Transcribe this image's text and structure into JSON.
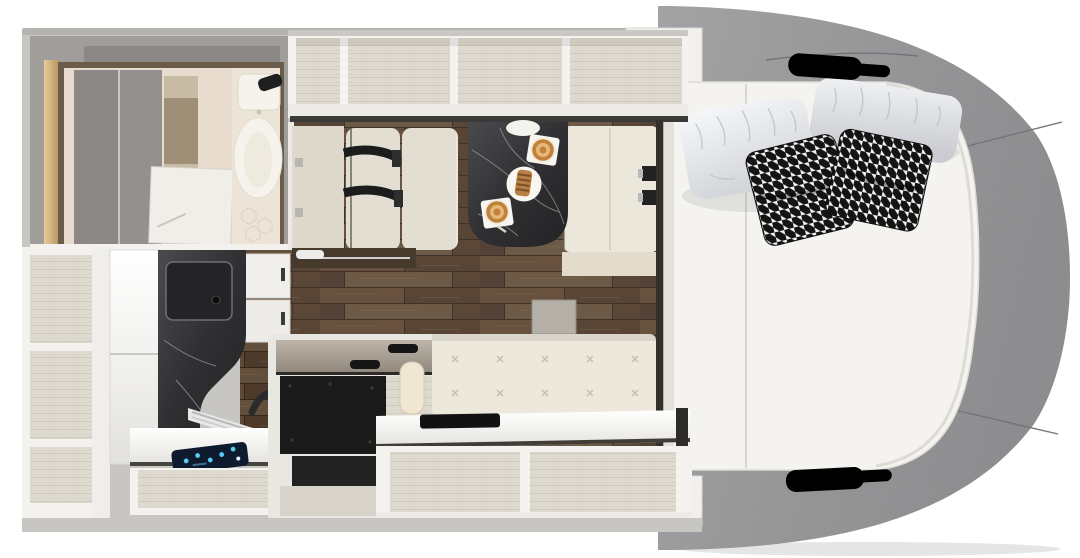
{
  "image_kind": "rv-motorhome-floor-plan-top-view-render",
  "palette": {
    "bg": "#ffffff",
    "wall": "#c7c6c2",
    "wall-dark": "#a5a4a0",
    "frame-white": "#f3f2ef",
    "shelf-interior": "#dedacf",
    "cream-floor": "#e6dfd1",
    "wood": "#57422f",
    "wood-dark": "#33261b",
    "marble": "#39393c",
    "cushion": "#ebe7da",
    "sofa": "#ece8dc",
    "bench-belt": "#1c1c1c",
    "mattress": "#f4f3ef",
    "mattress-seam": "#d8d6d0",
    "cab-fabric": "#8e8d8f",
    "cab-fabric-light": "#a3a2a4",
    "cab-fabric-dark": "#77767a",
    "pillow-white": "#eceef1",
    "houndstooth-black": "#141414",
    "houndstooth-white": "#f2f2f0",
    "appliance-black": "#1a1a1a",
    "trim-dark": "#33302b",
    "coffee": "#c28136",
    "coffee-foam": "#e4b87c",
    "plate-white": "#f8f6f1",
    "screen-blue": "#0e1b2e",
    "screen-glow": "#56ccf2",
    "bathroom-warm": "#e7dccd",
    "bathroom-door-gray": "#8b8885",
    "light-strip": "#d9b98b",
    "glass-top": "#a79f94"
  },
  "inventory": {
    "overhead_cabinet_compartments": 4,
    "left_shelf_compartments": 3,
    "under_counter_compartments": 2,
    "white_pillows": 2,
    "houndstooth_pillows": 2,
    "coffee_cups": 2,
    "pastry_plates": 1,
    "seat_belts_left_bench": 2,
    "seat_belt_buckles_right_bench": 2,
    "grab_handle_cutouts": 2
  },
  "regions": {
    "floorplan": {
      "label": "RV floor plan top view"
    },
    "bathroom": {
      "label": "Bathroom with toilet, shower and wardrobe doors"
    },
    "overhead_cabinets": {
      "label": "Overhead open storage compartments"
    },
    "dinette": {
      "label": "Dinette with two facing bench seats"
    },
    "table": {
      "label": "Dark marble dinette table with two coffees and a pastry"
    },
    "kitchen": {
      "label": "Kitchen block with marble sink counter and control screen"
    },
    "island": {
      "label": "Island cabinet with black appliance and glass top"
    },
    "sofa": {
      "label": "Tufted cream sofa bench"
    },
    "wood_floor": {
      "label": "Dark wood plank floor"
    },
    "bed": {
      "label": "Rear bed with mattress and four pillows"
    },
    "cab_surround": {
      "label": "Gray upholstered bed surround with grab handle cutouts"
    },
    "left_shelving": {
      "label": "Open shelving column"
    },
    "lower_shelving": {
      "label": "Open storage cubbies under rear counter"
    }
  }
}
